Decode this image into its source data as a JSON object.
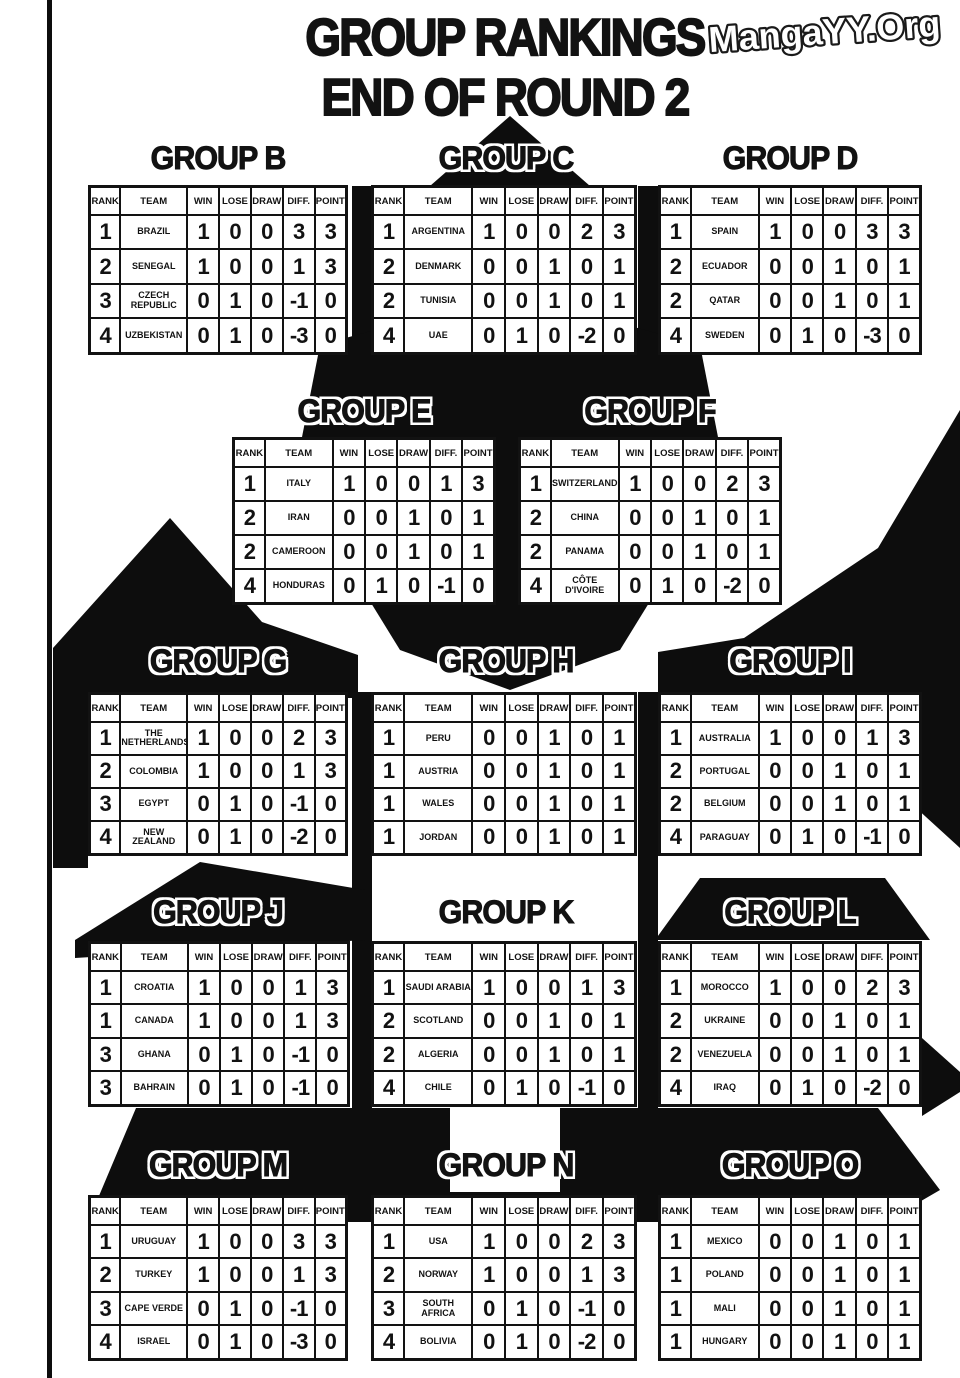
{
  "page": {
    "title_line1": "GROUP RANKINGS",
    "title_line2": "END OF ROUND 2",
    "watermark": "MangaYY.Org"
  },
  "colors": {
    "ink": "#121212",
    "paper": "#ffffff"
  },
  "table_headers": [
    "RANK",
    "TEAM",
    "WIN",
    "LOSE",
    "DRAW",
    "DIFF.",
    "POINT"
  ],
  "groups": [
    {
      "id": "B",
      "title": "GROUP B",
      "rows": [
        [
          "1",
          "BRAZIL",
          "1",
          "0",
          "0",
          "3",
          "3"
        ],
        [
          "2",
          "SENEGAL",
          "1",
          "0",
          "0",
          "1",
          "3"
        ],
        [
          "3",
          "CZECH REPUBLIC",
          "0",
          "1",
          "0",
          "-1",
          "0"
        ],
        [
          "4",
          "UZBEKISTAN",
          "0",
          "1",
          "0",
          "-3",
          "0"
        ]
      ]
    },
    {
      "id": "C",
      "title": "GROUP C",
      "rows": [
        [
          "1",
          "ARGENTINA",
          "1",
          "0",
          "0",
          "2",
          "3"
        ],
        [
          "2",
          "DENMARK",
          "0",
          "0",
          "1",
          "0",
          "1"
        ],
        [
          "2",
          "TUNISIA",
          "0",
          "0",
          "1",
          "0",
          "1"
        ],
        [
          "4",
          "UAE",
          "0",
          "1",
          "0",
          "-2",
          "0"
        ]
      ]
    },
    {
      "id": "D",
      "title": "GROUP D",
      "rows": [
        [
          "1",
          "SPAIN",
          "1",
          "0",
          "0",
          "3",
          "3"
        ],
        [
          "2",
          "ECUADOR",
          "0",
          "0",
          "1",
          "0",
          "1"
        ],
        [
          "2",
          "QATAR",
          "0",
          "0",
          "1",
          "0",
          "1"
        ],
        [
          "4",
          "SWEDEN",
          "0",
          "1",
          "0",
          "-3",
          "0"
        ]
      ]
    },
    {
      "id": "E",
      "title": "GROUP E",
      "rows": [
        [
          "1",
          "ITALY",
          "1",
          "0",
          "0",
          "1",
          "3"
        ],
        [
          "2",
          "IRAN",
          "0",
          "0",
          "1",
          "0",
          "1"
        ],
        [
          "2",
          "CAMEROON",
          "0",
          "0",
          "1",
          "0",
          "1"
        ],
        [
          "4",
          "HONDURAS",
          "0",
          "1",
          "0",
          "-1",
          "0"
        ]
      ]
    },
    {
      "id": "F",
      "title": "GROUP F",
      "rows": [
        [
          "1",
          "SWITZERLAND",
          "1",
          "0",
          "0",
          "2",
          "3"
        ],
        [
          "2",
          "CHINA",
          "0",
          "0",
          "1",
          "0",
          "1"
        ],
        [
          "2",
          "PANAMA",
          "0",
          "0",
          "1",
          "0",
          "1"
        ],
        [
          "4",
          "CÔTE D'IVOIRE",
          "0",
          "1",
          "0",
          "-2",
          "0"
        ]
      ]
    },
    {
      "id": "G",
      "title": "GROUP G",
      "rows": [
        [
          "1",
          "THE NETHERLANDS",
          "1",
          "0",
          "0",
          "2",
          "3"
        ],
        [
          "2",
          "COLOMBIA",
          "1",
          "0",
          "0",
          "1",
          "3"
        ],
        [
          "3",
          "EGYPT",
          "0",
          "1",
          "0",
          "-1",
          "0"
        ],
        [
          "4",
          "NEW ZEALAND",
          "0",
          "1",
          "0",
          "-2",
          "0"
        ]
      ]
    },
    {
      "id": "H",
      "title": "GROUP H",
      "rows": [
        [
          "1",
          "PERU",
          "0",
          "0",
          "1",
          "0",
          "1"
        ],
        [
          "1",
          "AUSTRIA",
          "0",
          "0",
          "1",
          "0",
          "1"
        ],
        [
          "1",
          "WALES",
          "0",
          "0",
          "1",
          "0",
          "1"
        ],
        [
          "1",
          "JORDAN",
          "0",
          "0",
          "1",
          "0",
          "1"
        ]
      ]
    },
    {
      "id": "I",
      "title": "GROUP I",
      "rows": [
        [
          "1",
          "AUSTRALIA",
          "1",
          "0",
          "0",
          "1",
          "3"
        ],
        [
          "2",
          "PORTUGAL",
          "0",
          "0",
          "1",
          "0",
          "1"
        ],
        [
          "2",
          "BELGIUM",
          "0",
          "0",
          "1",
          "0",
          "1"
        ],
        [
          "4",
          "PARAGUAY",
          "0",
          "1",
          "0",
          "-1",
          "0"
        ]
      ]
    },
    {
      "id": "J",
      "title": "GROUP J",
      "rows": [
        [
          "1",
          "CROATIA",
          "1",
          "0",
          "0",
          "1",
          "3"
        ],
        [
          "1",
          "CANADA",
          "1",
          "0",
          "0",
          "1",
          "3"
        ],
        [
          "3",
          "GHANA",
          "0",
          "1",
          "0",
          "-1",
          "0"
        ],
        [
          "3",
          "BAHRAIN",
          "0",
          "1",
          "0",
          "-1",
          "0"
        ]
      ]
    },
    {
      "id": "K",
      "title": "GROUP K",
      "rows": [
        [
          "1",
          "SAUDI ARABIA",
          "1",
          "0",
          "0",
          "1",
          "3"
        ],
        [
          "2",
          "SCOTLAND",
          "0",
          "0",
          "1",
          "0",
          "1"
        ],
        [
          "2",
          "ALGERIA",
          "0",
          "0",
          "1",
          "0",
          "1"
        ],
        [
          "4",
          "CHILE",
          "0",
          "1",
          "0",
          "-1",
          "0"
        ]
      ]
    },
    {
      "id": "L",
      "title": "GROUP L",
      "rows": [
        [
          "1",
          "MOROCCO",
          "1",
          "0",
          "0",
          "2",
          "3"
        ],
        [
          "2",
          "UKRAINE",
          "0",
          "0",
          "1",
          "0",
          "1"
        ],
        [
          "2",
          "VENEZUELA",
          "0",
          "0",
          "1",
          "0",
          "1"
        ],
        [
          "4",
          "IRAQ",
          "0",
          "1",
          "0",
          "-2",
          "0"
        ]
      ]
    },
    {
      "id": "M",
      "title": "GROUP M",
      "rows": [
        [
          "1",
          "URUGUAY",
          "1",
          "0",
          "0",
          "3",
          "3"
        ],
        [
          "2",
          "TURKEY",
          "1",
          "0",
          "0",
          "1",
          "3"
        ],
        [
          "3",
          "CAPE VERDE",
          "0",
          "1",
          "0",
          "-1",
          "0"
        ],
        [
          "4",
          "ISRAEL",
          "0",
          "1",
          "0",
          "-3",
          "0"
        ]
      ]
    },
    {
      "id": "N",
      "title": "GROUP N",
      "rows": [
        [
          "1",
          "USA",
          "1",
          "0",
          "0",
          "2",
          "3"
        ],
        [
          "2",
          "NORWAY",
          "1",
          "0",
          "0",
          "1",
          "3"
        ],
        [
          "3",
          "SOUTH AFRICA",
          "0",
          "1",
          "0",
          "-1",
          "0"
        ],
        [
          "4",
          "BOLIVIA",
          "0",
          "1",
          "0",
          "-2",
          "0"
        ]
      ]
    },
    {
      "id": "O",
      "title": "GROUP O",
      "rows": [
        [
          "1",
          "MEXICO",
          "0",
          "0",
          "1",
          "0",
          "1"
        ],
        [
          "1",
          "POLAND",
          "0",
          "0",
          "1",
          "0",
          "1"
        ],
        [
          "1",
          "MALI",
          "0",
          "0",
          "1",
          "0",
          "1"
        ],
        [
          "1",
          "HUNGARY",
          "0",
          "0",
          "1",
          "0",
          "1"
        ]
      ]
    }
  ]
}
